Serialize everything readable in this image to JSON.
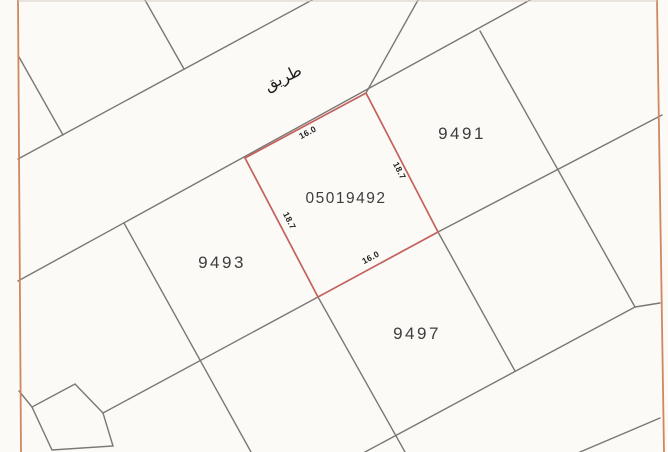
{
  "map": {
    "road_label": "طريق",
    "parcels": [
      {
        "id": "9491"
      },
      {
        "id": "9493"
      },
      {
        "id": "9497"
      }
    ],
    "highlight_parcel": {
      "id": "05019492",
      "dim_top": "16.0",
      "dim_right": "18.7",
      "dim_left": "18.7",
      "dim_bottom": "16.0"
    },
    "colors": {
      "background": "#fbfaf7",
      "map_border": "#cd8862",
      "top_edge_line": "#d6ccc0",
      "boundary_line": "#7b7774",
      "highlight_outline": "#c4615c",
      "label_text": "#3d3d3d",
      "dim_text": "#222222",
      "road_text": "#1d1d1d"
    }
  }
}
